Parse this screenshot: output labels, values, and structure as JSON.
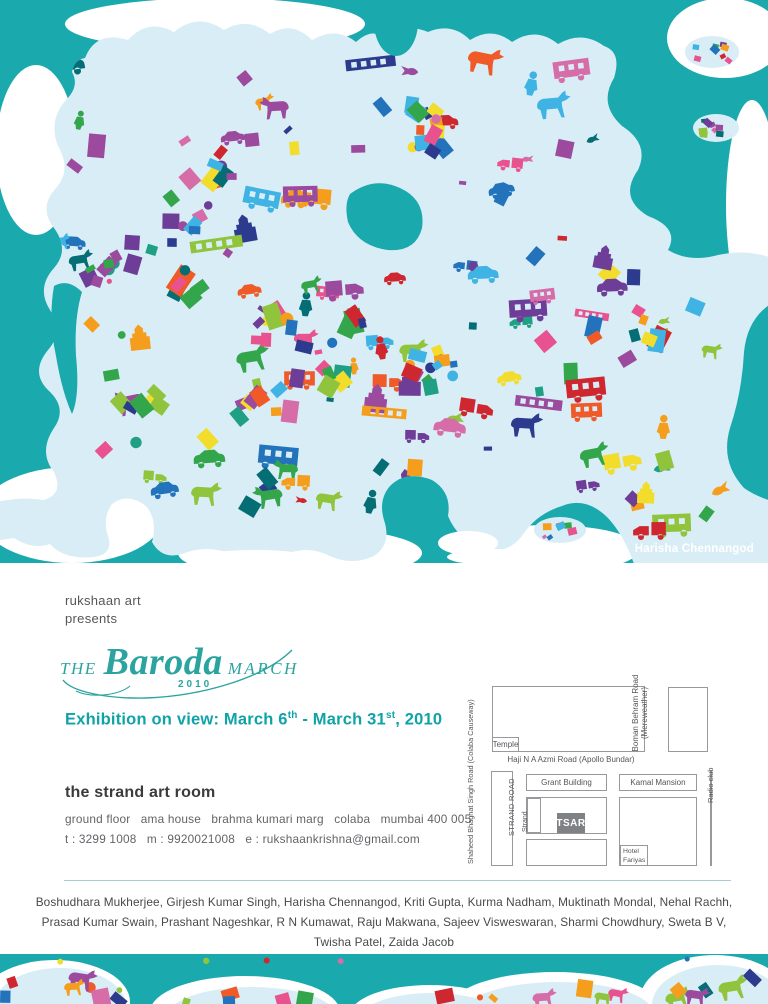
{
  "artwork": {
    "credit": "Harisha Chennangod",
    "bg_color": "#1aa9ad",
    "land_color": "#d9edf6",
    "white_color": "#ffffff",
    "palette": [
      "#cf2730",
      "#e8538f",
      "#ef5a28",
      "#f59e1d",
      "#f2dc2c",
      "#8fc43c",
      "#33a64c",
      "#1f9f84",
      "#3fb3e3",
      "#2273bb",
      "#2c3b8e",
      "#6d3d97",
      "#9c4a9e",
      "#d66ca8",
      "#056e74"
    ],
    "motifs": [
      "confetti-square",
      "dot",
      "cow",
      "bus",
      "truck",
      "car",
      "person",
      "train",
      "temple",
      "bird"
    ]
  },
  "presenter": {
    "line1": "rukshaan art",
    "line2": "presents"
  },
  "logo": {
    "the": "THE",
    "name": "Baroda",
    "march": "MARCH",
    "year": "2010",
    "color": "#2ba4a0"
  },
  "exhibition": {
    "p1": "Exhibition on view:  March 6",
    "sup1": "th",
    "p2": " - March 31",
    "sup2": "st",
    "p3": ", 2010",
    "color": "#0fa3a9"
  },
  "venue": {
    "name": "the strand art room",
    "address": "ground floor   ama house   brahma kumari marg   colaba   mumbai 400 005",
    "contact": "t : 3299 1008   m : 9920021008   e : rukshaankrishna@gmail.com"
  },
  "map": {
    "left_road": "Shaheed Bhaghat Singh Road (Colaba Causeway)",
    "temple": "Temple",
    "top_road": "Haji N A Azmi Road (Apollo Bundar)",
    "right_road_1": "Boman Behram Road",
    "right_road_2": "(Mereweather)",
    "grant": "Grant Building",
    "kamal": "Kamal Mansion",
    "strand_road": "STRAND ROAD",
    "strand": "Strand",
    "tsar": "TSAR",
    "hotel_1": "Hotel",
    "hotel_2": "Fariyas",
    "radio": "Radio club"
  },
  "artists": {
    "lines": [
      "Boshudhara Mukherjee, Girjesh Kumar Singh, Harisha Chennangod, Kriti Gupta, Kurma Nadham, Muktinath Mondal, Nehal Rachh,",
      "Prasad Kumar Swain, Prashant Nageshkar, R N Kumawat, Raju Makwana, Sajeev Visweswaran, Sharmi Chowdhury, Sweta B V,",
      "Twisha Patel, Zaida Jacob"
    ]
  }
}
